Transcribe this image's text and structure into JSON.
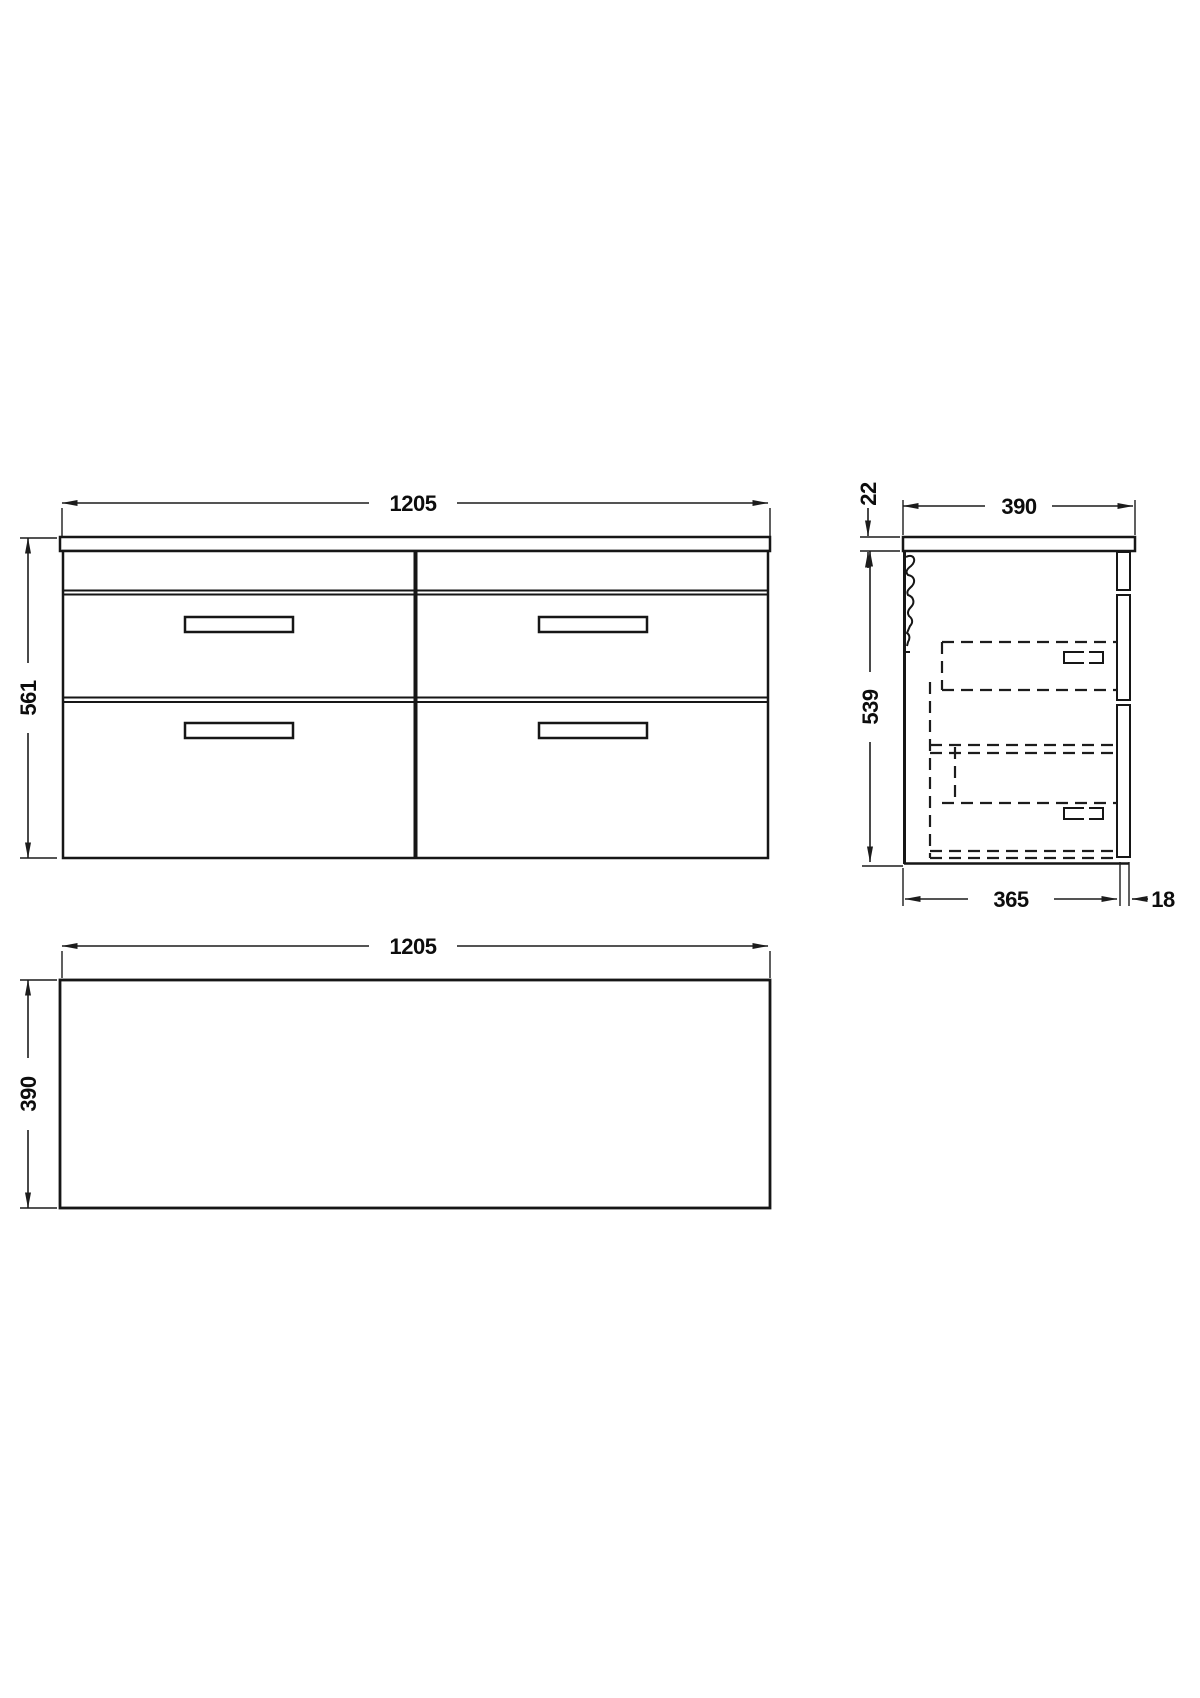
{
  "page": {
    "background": "#ffffff",
    "line_color": "#161616",
    "description": "Technical dimension drawing of a wall-hung 4-drawer vanity unit: front elevation, side section and plan view"
  },
  "front_view": {
    "width": "1205",
    "height": "561"
  },
  "side_view": {
    "counter_thickness": "22",
    "total_depth": "390",
    "cabinet_height": "539",
    "carcass_depth": "365",
    "front_thickness": "18"
  },
  "plan_view": {
    "width": "1205",
    "depth": "390"
  }
}
